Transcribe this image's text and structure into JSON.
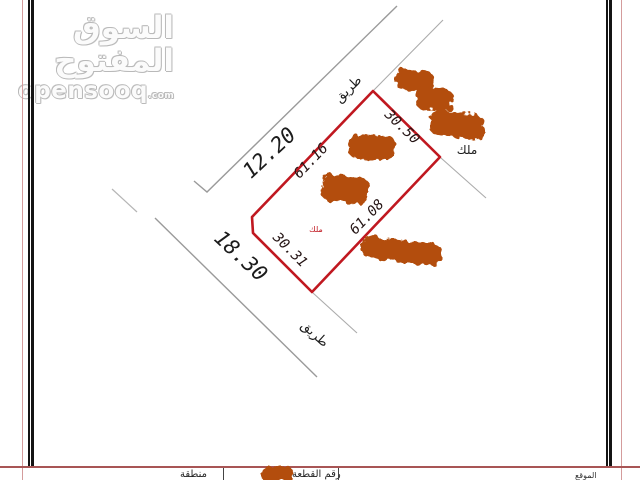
{
  "watermark": {
    "logo_ar": "السوق المفتوح",
    "site": "opensooq",
    "tld": ".com"
  },
  "map": {
    "road_top": {
      "label": "طريق",
      "dimension": "12.20"
    },
    "road_bottom": {
      "label": "طريق",
      "dimension": "18.30"
    },
    "plot": {
      "edge_nw": "61.16",
      "edge_ne": "30.50",
      "edge_se": "61.08",
      "edge_sw": "30.31",
      "owner_mark": "ملك"
    },
    "neighbor_right_label": "ملك",
    "faint_plot_number": "4773",
    "faint_letter": "H"
  },
  "footer": {
    "region_label": "منطقة",
    "plot_no_label": "رقم القطعة",
    "right_label": "الموقع"
  },
  "colors": {
    "plot_boundary": "#c01820",
    "redaction": "#b34e0e",
    "frame_red": "#a85555",
    "frame_black": "#141414",
    "road_gray": "#9a9a9a",
    "outer_pink": "#d49c9c"
  }
}
